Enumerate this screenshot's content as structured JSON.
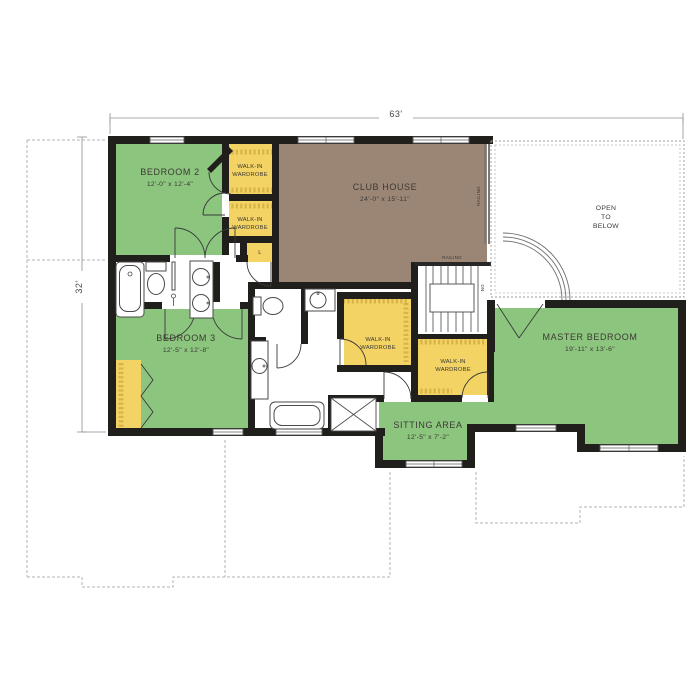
{
  "colors": {
    "room_green": "#8cc57e",
    "closet_yellow": "#f2d363",
    "clubhouse_brown": "#9b8676",
    "wall": "#211f1c"
  },
  "dimensions": {
    "width": "63'",
    "height": "32'"
  },
  "rooms": {
    "bedroom2": {
      "name": "BEDROOM 2",
      "size": "12'-0\" x 12'-4\""
    },
    "bedroom3": {
      "name": "BEDROOM 3",
      "size": "12'-5\" x 12'-8\""
    },
    "club_house": {
      "name": "CLUB HOUSE",
      "size": "24'-0\" x 15'-11\""
    },
    "master_bedroom": {
      "name": "MASTER BEDROOM",
      "size": "19'-11\" x 13'-6\""
    },
    "sitting_area": {
      "name": "SITTING AREA",
      "size": "12'-5\" x 7'-2\""
    },
    "open_to_below": {
      "line1": "OPEN",
      "line2": "TO",
      "line3": "BELOW"
    },
    "walk_in_wardrobe": {
      "line1": "WALK-IN",
      "line2": "WARDROBE"
    },
    "linen": "L"
  },
  "annotations": {
    "railing": "RAILING",
    "down": "DN"
  }
}
